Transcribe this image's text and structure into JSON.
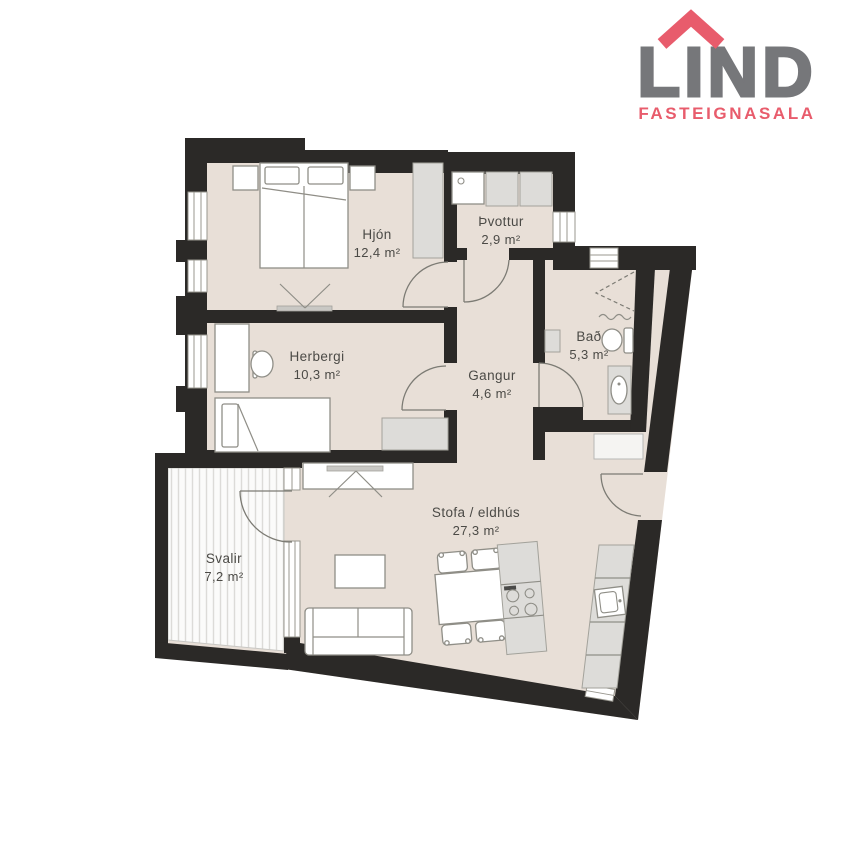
{
  "logo": {
    "brand": "LIND",
    "tagline": "FASTEIGNASALA",
    "brand_color": "#76777a",
    "accent_color": "#e85c6c",
    "icon": "house-roof-icon"
  },
  "plan": {
    "rooms": [
      {
        "id": "hjon",
        "name": "Hjón",
        "area": "12,4 m²"
      },
      {
        "id": "thvottur",
        "name": "Þvottur",
        "area": "2,9 m²"
      },
      {
        "id": "bad",
        "name": "Bað",
        "area": "5,3 m²"
      },
      {
        "id": "herbergi",
        "name": "Herbergi",
        "area": "10,3 m²"
      },
      {
        "id": "gangur",
        "name": "Gangur",
        "area": "4,6 m²"
      },
      {
        "id": "stofa",
        "name": "Stofa / eldhús",
        "area": "27,3 m²"
      },
      {
        "id": "svalir",
        "name": "Svalir",
        "area": "7,2 m²"
      }
    ],
    "colors": {
      "wall": "#2b2927",
      "floor": "#e8dfd7",
      "furniture_outline": "#8f8e87",
      "cabinet_fill": "#dddcd9",
      "label_text": "#4b4a46"
    }
  }
}
